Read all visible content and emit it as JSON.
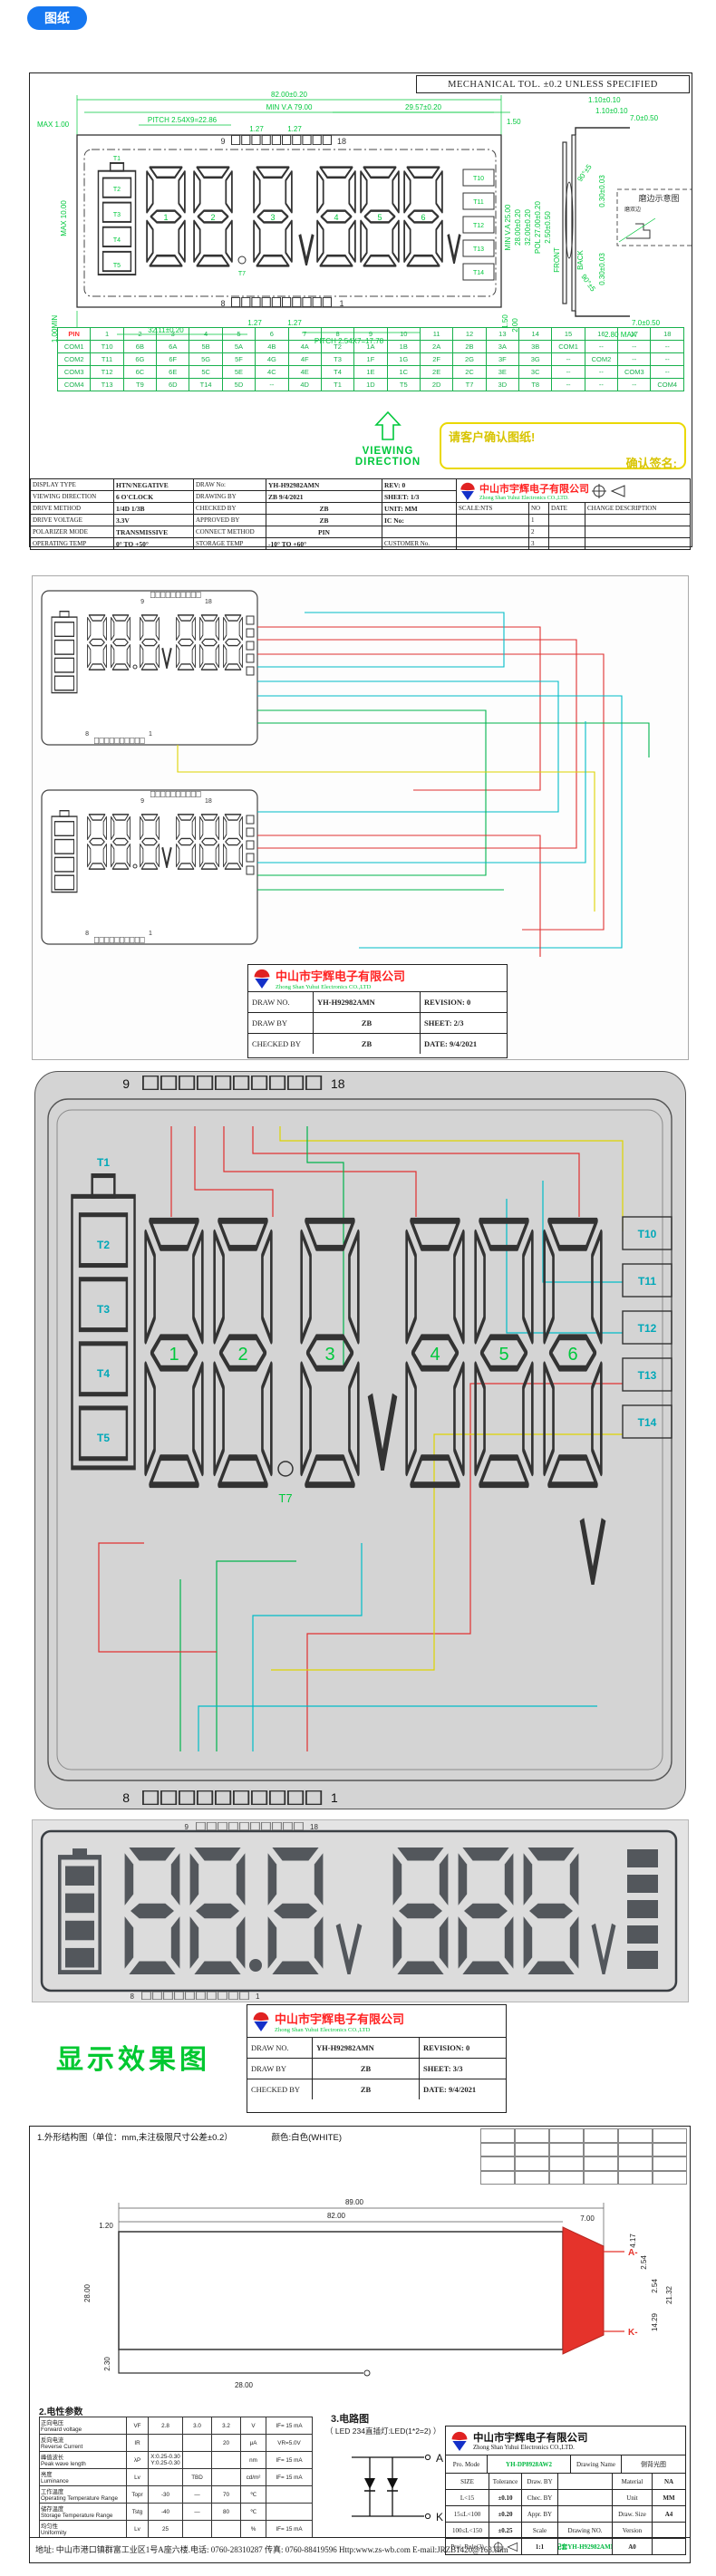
{
  "badge": {
    "label": "图纸"
  },
  "sheet1": {
    "mech_tol": "MECHANICAL TOL. ±0.2 UNLESS SPECIFIED",
    "dims": {
      "max100": "MAX 1.00",
      "w82": "82.00±0.20",
      "minva79": "MIN V.A 79.00",
      "pitch9": "PITCH 2.54X9=22.86",
      "g127a": "1.27",
      "g127b": "1.27",
      "w2957": "29.57±0.20",
      "g150": "1.50",
      "max10": "MAX 10.00",
      "w3211": "32.11±0.20",
      "g127c": "1.27",
      "g127d": "1.27",
      "pitch7": "PITCH 2.54X7=17.78",
      "min100": "1.00MIN",
      "g150b": "1.50",
      "g200": "2.00",
      "t110a": "1.10±0.10",
      "t110b": "1.10±0.10",
      "t70": "7.0±0.50",
      "ang90a": "90°±5",
      "ang90b": "90°±5",
      "t030a": "0.30±0.03",
      "t030b": "0.30±0.03",
      "minva25": "MIN V.A 25.00",
      "h28": "28.00±0.20",
      "h32": "32.00±0.20",
      "pol27": "POL 27.00±0.20",
      "t250": "2.50±0.50",
      "front": "FRONT",
      "back": "BACK",
      "max280": "2.80 MAX",
      "t70b": "7.0±0.50"
    },
    "pins": {
      "top_left": "9",
      "top_right": "18",
      "bottom_left": "8",
      "bottom_right": "1"
    },
    "seg_labels": {
      "t1": "T1",
      "t2": "T2",
      "t3": "T3",
      "t4": "T4",
      "t5": "T5",
      "t7": "T7",
      "t10": "T10",
      "t11": "T11",
      "t12": "T12",
      "t13": "T13",
      "t14": "T14"
    },
    "digit_labels": [
      "1",
      "2",
      "3",
      "4",
      "5",
      "6"
    ],
    "grind": {
      "title": "磨边示意图",
      "sub": "磨双边"
    },
    "viewing_direction": "VIEWING DIRECTION",
    "confirm": {
      "line1": "请客户确认图纸!",
      "line2": "确认签名:"
    },
    "pin_table": {
      "rows": [
        [
          "PIN",
          "1",
          "2",
          "3",
          "4",
          "5",
          "6",
          "7",
          "8",
          "9",
          "10",
          "11",
          "12",
          "13",
          "14",
          "15",
          "16",
          "17",
          "18"
        ],
        [
          "COM1",
          "T10",
          "6B",
          "6A",
          "5B",
          "5A",
          "4B",
          "4A",
          "T2",
          "1A",
          "1B",
          "2A",
          "2B",
          "3A",
          "3B",
          "COM1",
          "--",
          "--",
          "--"
        ],
        [
          "COM2",
          "T11",
          "6G",
          "6F",
          "5G",
          "5F",
          "4G",
          "4F",
          "T3",
          "1F",
          "1G",
          "2F",
          "2G",
          "3F",
          "3G",
          "--",
          "COM2",
          "--",
          "--"
        ],
        [
          "COM3",
          "T12",
          "6C",
          "6E",
          "5C",
          "5E",
          "4C",
          "4E",
          "T4",
          "1E",
          "1C",
          "2E",
          "2C",
          "3E",
          "3C",
          "--",
          "--",
          "COM3",
          "--"
        ],
        [
          "COM4",
          "T13",
          "T9",
          "6D",
          "T14",
          "5D",
          "--",
          "4D",
          "T1",
          "1D",
          "T5",
          "2D",
          "T7",
          "3D",
          "T8",
          "--",
          "--",
          "--",
          "COM4"
        ]
      ]
    },
    "spec": {
      "display_type_label": "DISPLAY TYPE",
      "display_type": "HTN/NEGATIVE",
      "draw_no_label": "DRAW No:",
      "draw_no": "YH-H92982AMN",
      "rev": "REV:  0",
      "viewing_label": "VIEWING DIRECTION",
      "viewing": "6 O'CLOCK",
      "drawing_by_label": "DRAWING BY",
      "drawing_by": "ZB   9/4/2021",
      "sheet": "SHEET: 1/3",
      "drive_method_label": "DRIVE METHOD",
      "drive_method": "1/4D  1/3B",
      "checked_label": "CHECKED BY",
      "checked": "ZB",
      "unit": "UNIT: MM",
      "scale": "SCALE:NTS",
      "no": "NO",
      "date": "DATE",
      "change": "CHANGE DESCRIPTION",
      "voltage_label": "DRIVE VOLTAGE",
      "voltage": "3.3V",
      "approved_label": "APPROVED BY",
      "approved": "ZB",
      "ic": "IC No:",
      "n1": "1",
      "polarizer_label": "POLARIZER MODE",
      "polarizer": "TRANSMISSIVE",
      "connect_label": "CONNECT METHOD",
      "connect": "PIN",
      "n2": "2",
      "optemp_label": "OPERATING TEMP",
      "optemp": "0°  TO  +50°",
      "storage_label": "STORAGE TEMP",
      "storage": "-10°  TO  +60°",
      "customer": "CUSTOMER No.",
      "n3": "3"
    },
    "company": {
      "cn": "中山市宇辉电子有限公司",
      "en": "Zhong Shan Yuhui Electronics CO.,LTD."
    }
  },
  "sheet2": {
    "pins": {
      "top_left": "9",
      "top_right": "18",
      "bottom_left": "8",
      "bottom_right": "1"
    },
    "title_block": {
      "company_cn": "中山市宇辉电子有限公司",
      "company_en": "Zhong Shan Yuhui Electronics CO.,LTD",
      "draw_no_label": "DRAW NO.",
      "draw_no": "YH-H92982AMN",
      "revision": "REVISION:  0",
      "draw_by_label": "DRAW BY",
      "draw_by": "ZB",
      "sheet": "SHEET: 2/3",
      "checked_label": "CHECKED BY",
      "checked": "ZB",
      "date": "DATE: 9/4/2021"
    }
  },
  "sheet3": {
    "pins": {
      "top_left": "9",
      "top_right": "18",
      "bottom_left": "8",
      "bottom_right": "1"
    },
    "seg_labels": {
      "t1": "T1",
      "t2": "T2",
      "t3": "T3",
      "t4": "T4",
      "t5": "T5",
      "t7": "T7",
      "t10": "T10",
      "t11": "T11",
      "t12": "T12",
      "t13": "T13",
      "t14": "T14"
    },
    "digit_labels": [
      "1",
      "2",
      "3",
      "4",
      "5",
      "6"
    ]
  },
  "display_sheet": {
    "pins": {
      "top_left": "9",
      "top_right": "18",
      "bottom_left": "8",
      "bottom_right": "1"
    },
    "caption": "显示效果图",
    "title_block": {
      "company_cn": "中山市宇辉电子有限公司",
      "company_en": "Zhong Shan Yuhui Electronics CO.,LTD",
      "draw_no_label": "DRAW NO.",
      "draw_no": "YH-H92982AMN",
      "revision": "REVISION:  0",
      "draw_by_label": "DRAW BY",
      "draw_by": "ZB",
      "sheet": "SHEET: 3/3",
      "checked_label": "CHECKED BY",
      "checked": "ZB",
      "date": "DATE: 9/4/2021"
    }
  },
  "backlight": {
    "heading": "1.外形结构图（单位：mm,未注极限尺寸公差±0.2）",
    "color_note": "颜色:白色(WHITE)",
    "dims": {
      "w89": "89.00",
      "w82": "82.00",
      "t120": "1.20",
      "t700": "7.00",
      "h280": "28.00",
      "d417": "4.17",
      "d254a": "2.54",
      "d254b": "2.54",
      "d1429": "14.29",
      "d2132": "21.32",
      "d230": "2.30",
      "w2800": "28.00"
    },
    "labels": {
      "a": "A-",
      "k": "K-"
    },
    "elec_title": "2.电性参数",
    "elec_rows": [
      [
        "正向电压\nForward voltage",
        "VF",
        "2.8",
        "3.0",
        "3.2",
        "V",
        "IF= 15 mA"
      ],
      [
        "反向电流\nReverse Current",
        "IR",
        "",
        "",
        "20",
        "μA",
        "VR=5.0V"
      ],
      [
        "峰值波长\nPeak wave length",
        "λP",
        "X:0.25-0.30\nY:0.25-0.30",
        "",
        "",
        "nm",
        "IF= 15 mA"
      ],
      [
        "亮度\nLuminance",
        "Lv",
        "",
        "TBD",
        "",
        "cd/m²",
        "IF= 15 mA"
      ],
      [
        "工作温度\nOperating Temperature Range",
        "Topr",
        "-30",
        "—",
        "70",
        "℃",
        ""
      ],
      [
        "储存温度\nStorage Temperature Range",
        "Tstg",
        "-40",
        "—",
        "80",
        "℃",
        ""
      ],
      [
        "均匀性\nUniformity",
        "Lv",
        "25",
        "",
        "",
        "%",
        "IF= 15 mA"
      ]
    ],
    "circuit_title": "3.电路图",
    "circuit_sub": "（ LED 234直插灯:LED(1*2=2) ）",
    "terminal_a": "A",
    "terminal_k": "K",
    "title_block": {
      "company_cn": "中山市宇辉电子有限公司",
      "company_en": "Zhong Shan Yuhui Electronics CO.,LTD.",
      "pro_mode_label": "Pro. Mode",
      "pro_mode": "YH-DP8928AW2",
      "drawing_name_label": "Drawing Name",
      "drawing_name": "侧背光图",
      "size": "SIZE",
      "tolerance": "Tolerance",
      "r1l": "L<15",
      "r1v": "±0.10",
      "r2l": "15≤L<100",
      "r2v": "±0.20",
      "r3l": "100≤L<150",
      "r3v": "±0.25",
      "proj": "Proj. Rule(3)",
      "draw_by": "Draw. BY",
      "chec_by": "Chec. BY",
      "appr_by": "Appr. BY",
      "scale_label": "Scale",
      "scale": "1:1",
      "drawing_no_label": "Drawing NO.",
      "drawing_no": "配套YH-H92982AMN",
      "material_label": "Material",
      "material": "NA",
      "unit_label": "Unit",
      "unit": "MM",
      "size_label": "Draw. Size",
      "draw_size": "A4",
      "version_label": "Version",
      "version": "A0"
    },
    "footer": "地址: 中山市港口镇群富工业区1号A座六楼.电话: 0760-28310287 传真: 0760-88419596 Http:www.zs-wb.com E-mail:JRZB1420@163.com"
  }
}
